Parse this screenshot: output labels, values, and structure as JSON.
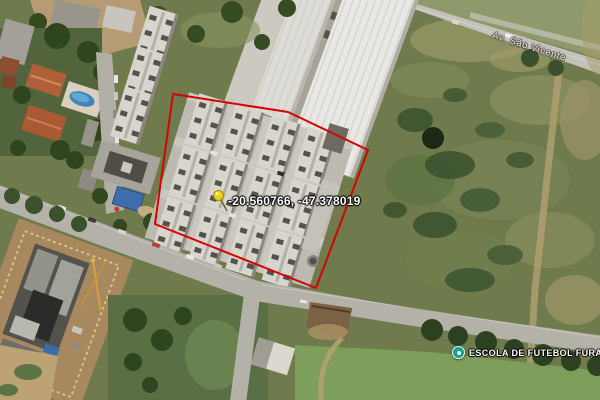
{
  "map": {
    "marker": {
      "coordinates": "-20.560766, -47.378019",
      "icon": "yellow-pushpin",
      "pin_color": "#f2cf1d"
    },
    "road_label": "Av. São Vicente",
    "poi": {
      "name": "ESCOLA DE FUTEBOL FURACÃO",
      "icon": "sports-poi",
      "icon_color": "#14a294"
    },
    "boundary": {
      "stroke": "#d60000",
      "points": "173,94 288,112 368,150 316,288 155,224"
    },
    "terrain_colors": {
      "pasture": "#6f7b4c",
      "mowed_field": "#7e9e5c",
      "trees": "#2e4520",
      "road": "#b4b1a9",
      "dirt": "#b29364",
      "warehouse_roof": "#e9e8e4",
      "apartment_roof": "#d8d5ce",
      "house_roof": "#b06038",
      "pool": "#3f86bb",
      "construction": "#53524d"
    }
  }
}
